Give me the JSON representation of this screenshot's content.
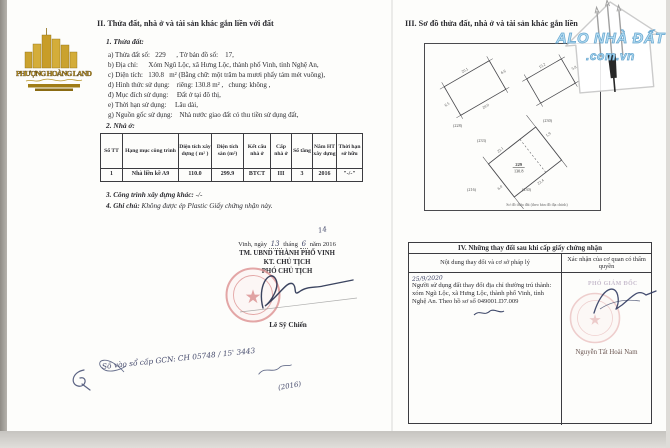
{
  "logo_left": {
    "brand": "PHƯỢNG HOÀNG LAND"
  },
  "logo_right": {
    "brand": "ALO NHÀ ĐẤT",
    "domain": ".com.vn"
  },
  "section2": {
    "title": "II. Thửa đất, nhà ở và tài sản khác gắn liền với đất",
    "plot": {
      "heading": "1. Thửa đất:",
      "lines": [
        "a) Thửa đất số:   229      , Tờ bản đồ số:    17,",
        "b) Địa chỉ:      Xóm Ngũ Lộc, xã Hưng Lộc, thành phố Vinh, tỉnh Nghệ An,",
        "c) Diện tích:   130.8   m² (Bằng chữ: một trăm ba mươi phẩy tám mét vuông),",
        "d) Hình thức sử dụng:    riêng: 130.8 m² ,   chung: không ,",
        "đ) Mục đích sử dụng:     Đất ở tại đô thị,",
        "e) Thời hạn sử dụng:     Lâu dài,",
        "g) Nguồn gốc sử dụng:    Nhà nước giao đất có thu tiền sử dụng đất,"
      ]
    },
    "house": {
      "heading": "2. Nhà ở:",
      "headers": [
        "Số TT",
        "Hạng mục công trình",
        "Diện tích xây dựng ( m² )",
        "Diện tích sàn (m²)",
        "Kết cấu nhà ở",
        "Cấp nhà ở",
        "Số tầng",
        "Năm HT xây dựng",
        "Thời hạn sở hữu"
      ],
      "row": [
        "1",
        "Nhà liền kề A9",
        "110.0",
        "299.9",
        "BTCT",
        "III",
        "3",
        "2016",
        "\"-/-\""
      ]
    },
    "other_label": "3. Công trình xây dựng khác:",
    "other_value": "-/-",
    "note_label": "4. Ghi chú:",
    "note_value": "Không được ép Plastic Giấy chứng nhận này.",
    "signing": {
      "page_no": "14",
      "place": "Vinh, ngày",
      "day": "13",
      "thang": "tháng",
      "month": "6",
      "year": "năm 2016",
      "org": "TM. UBND THÀNH PHỐ VINH",
      "kt": "KT. CHỦ TỊCH",
      "deputy": "PHÓ CHỦ TỊCH",
      "signer": "Lê Sỹ Chiến"
    },
    "registry_note": "Số vào sổ cấp GCN: CH 05748 / 15' 3443",
    "registry_year": "(2016)"
  },
  "section3": {
    "title": "III. Sơ đồ thửa đất, nhà ở và tài sản khác gắn liền",
    "diagram": {
      "caption": "Sơ đồ thửa đất (theo bản đồ địa chính)",
      "main_no": "229",
      "main_area": "130.8",
      "label_a": "(228)",
      "label_b": "(230)",
      "n1": "(233)",
      "n2": "(216)",
      "n3": "(230)",
      "dims": {
        "a_top": "20.1",
        "a_bottom": "20.0",
        "a_left": "6.5",
        "a_right": "6.6",
        "b_top": "15.2",
        "b_right": "5.8",
        "c_top": "22.1",
        "c_bottom": "22.4",
        "c_left": "6.0",
        "c_right": "5.9"
      }
    }
  },
  "section4": {
    "title": "IV. Những thay đổi sau khi cấp giấy chứng nhận",
    "col1_header": "Nội dung thay đổi và cơ sở pháp lý",
    "col2_header": "Xác nhận của cơ quan có thẩm quyền",
    "entry_date": "25/9/2020",
    "entry_text": "Người sử dụng đất thay đổi địa chỉ thường trú thành: xóm Ngũ Lộc, xã Hưng Lộc, thành phố Vinh, tỉnh Nghệ An. Theo hồ sơ số 049001.D7.009",
    "approver_title": "PHÓ GIÁM ĐỐC",
    "approver_name": "Nguyễn Tất Hoài Nam"
  }
}
